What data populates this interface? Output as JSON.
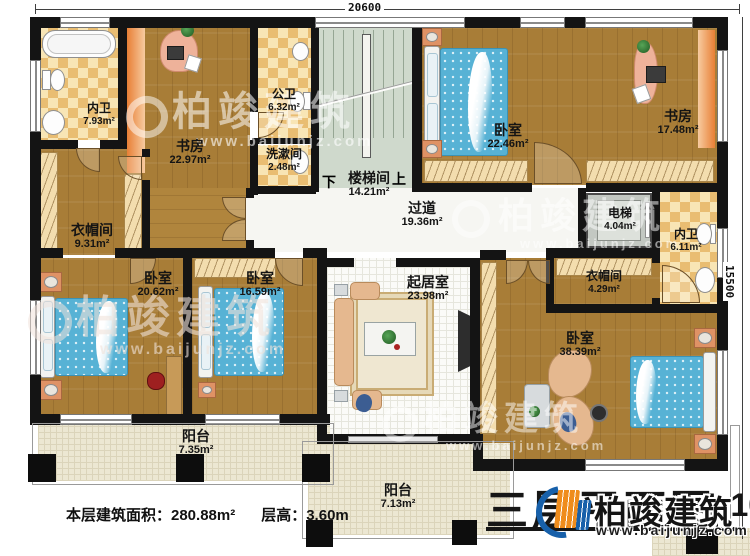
{
  "dimensions": {
    "top": "20600",
    "right": "15500"
  },
  "stairs": {
    "down": "下",
    "up": "上"
  },
  "rooms": {
    "neiwei1": {
      "name": "内卫",
      "area": "7.93m²"
    },
    "yimao1": {
      "name": "衣帽间",
      "area": "9.31m²"
    },
    "shufang1": {
      "name": "书房",
      "area": "22.97m²"
    },
    "gongwei": {
      "name": "公卫",
      "area": "6.32m²"
    },
    "xishu": {
      "name": "洗漱间",
      "area": "2.48m²"
    },
    "louti": {
      "name": "楼梯间",
      "area": "14.21m²"
    },
    "woshi1": {
      "name": "卧室",
      "area": "22.46m²"
    },
    "shufang2": {
      "name": "书房",
      "area": "17.48m²"
    },
    "guodao": {
      "name": "过道",
      "area": "19.36m²"
    },
    "dianti": {
      "name": "电梯",
      "area": "4.04m²"
    },
    "neiwei2": {
      "name": "内卫",
      "area": "6.11m²"
    },
    "yimao2": {
      "name": "衣帽间",
      "area": "4.29m²"
    },
    "woshi2": {
      "name": "卧室",
      "area": "20.62m²"
    },
    "woshi3": {
      "name": "卧室",
      "area": "16.59m²"
    },
    "qiju": {
      "name": "起居室",
      "area": "23.98m²"
    },
    "woshi4": {
      "name": "卧室",
      "area": "38.39m²"
    },
    "yangtai1": {
      "name": "阳台",
      "area": "7.35m²"
    },
    "yangtai2": {
      "name": "阳台",
      "area": "7.13m²"
    }
  },
  "footer": {
    "area": "本层建筑面积：280.88m²",
    "height": "层高：3.60m"
  },
  "title": {
    "text": "三层平面图",
    "scale": "1:100"
  },
  "watermark": {
    "brand": "柏竣建筑",
    "url": "www.baijunjz.com"
  },
  "logo": {
    "brand": "柏竣建筑",
    "url": "www.baijunjz.com"
  },
  "colors": {
    "wall": "#141414",
    "wood": "#a87d37",
    "tile": "#e9bd72",
    "bed": "#57b2d5",
    "accent_orange": "#ef8c1c",
    "accent_blue": "#1760aa"
  }
}
